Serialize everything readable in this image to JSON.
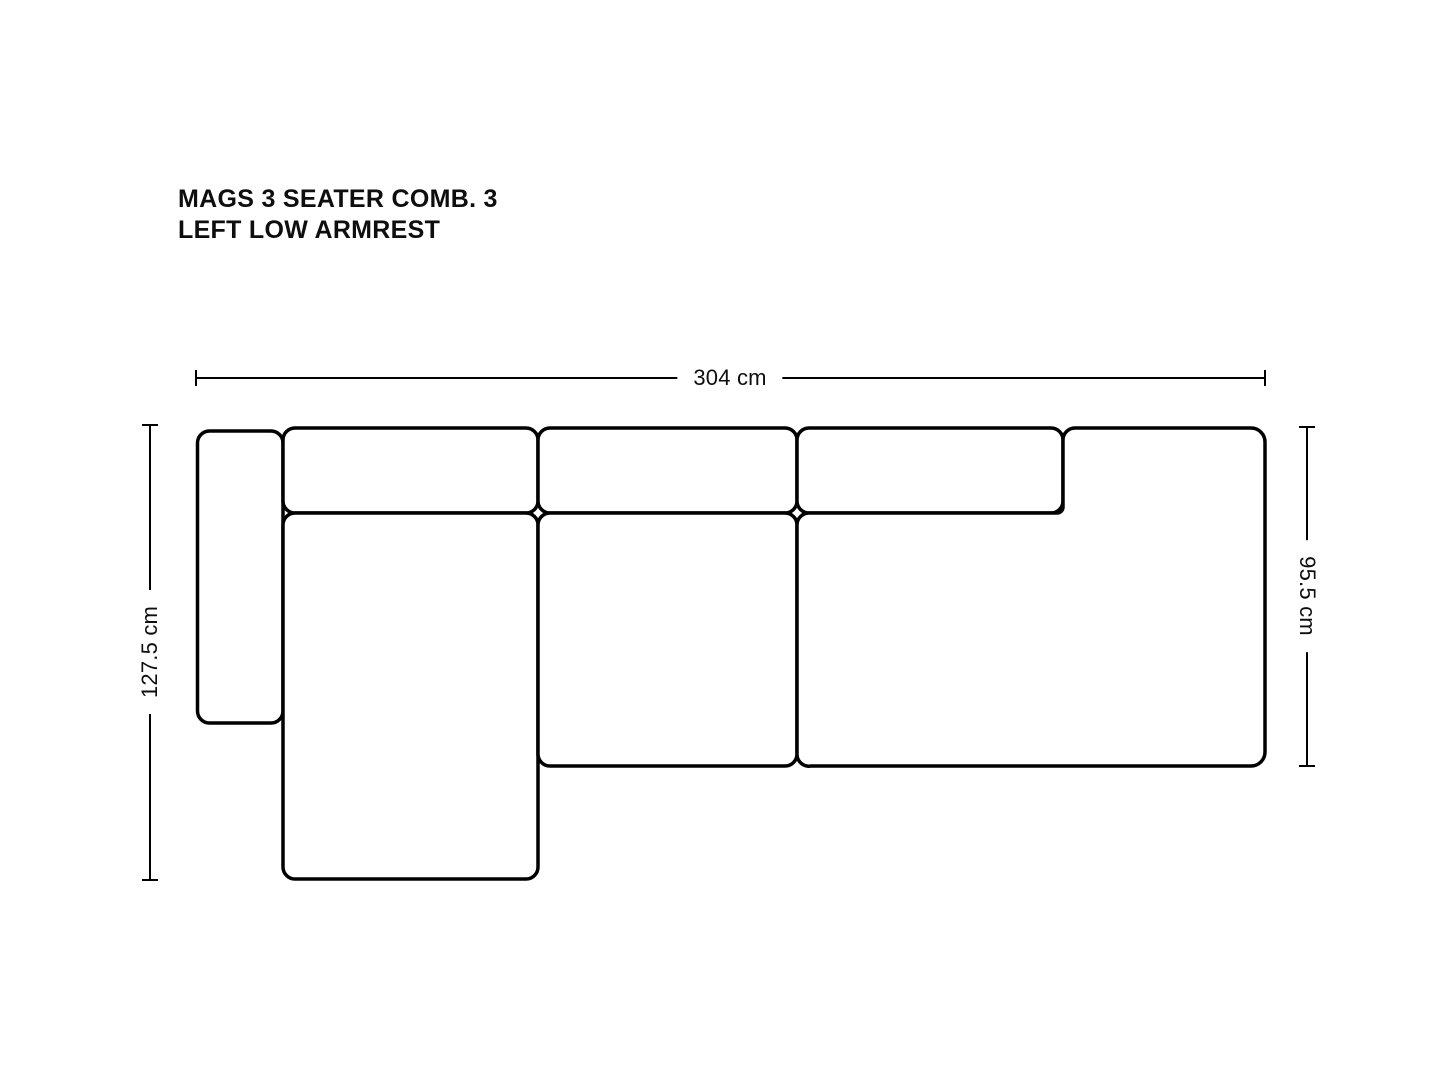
{
  "page": {
    "background_color": "#ffffff",
    "line_color": "#000000",
    "text_color": "#0e0e0e"
  },
  "title": {
    "line1": "MAGS 3 SEATER COMB. 3",
    "line2": "LEFT LOW ARMREST"
  },
  "dimensions": {
    "width": {
      "label": "304 cm",
      "orientation": "horizontal"
    },
    "depth_left": {
      "label": "127.5 cm",
      "orientation": "vertical-reading-up"
    },
    "depth_right": {
      "label": "95.5 cm",
      "orientation": "vertical-reading-down"
    }
  },
  "diagram": {
    "description": "Top view outline drawing of MAGS 3 seater sofa combination 3 with left low armrest and left chaise",
    "module_stroke_width": 3.5,
    "dim_stroke_width": 2,
    "rects": [
      {
        "name": "left-low-armrest",
        "x": 197.5,
        "y": 431,
        "w": 85.5,
        "h": 292,
        "r": 12
      },
      {
        "name": "back-cushion-1",
        "x": 283,
        "y": 428,
        "w": 255,
        "h": 85,
        "r": 12
      },
      {
        "name": "back-cushion-2",
        "x": 538,
        "y": 428,
        "w": 259,
        "h": 85,
        "r": 12
      },
      {
        "name": "back-cushion-3",
        "x": 797,
        "y": 428,
        "w": 266,
        "h": 85,
        "r": 12
      },
      {
        "name": "chaise-longue-seat",
        "x": 283,
        "y": 513,
        "w": 255,
        "h": 366,
        "r": 12
      },
      {
        "name": "middle-seat",
        "x": 538,
        "y": 513,
        "w": 259,
        "h": 253,
        "r": 12
      }
    ],
    "paths": [
      {
        "name": "right-seat-with-armrest",
        "d": "M 1075 428 H 1251 A 14 14 0 0 1 1265 442 V 752 A 14 14 0 0 1 1251 766 H 811 A 12 12 0 0 1 797 754 V 525 A 12 12 0 0 1 809 513 H 1057 A 6 6 0 0 0 1063 507 V 440 A 12 12 0 0 1 1075 428 Z"
      }
    ],
    "dim_lines": [
      {
        "name": "dim-width-line",
        "x1": 196,
        "y1": 378,
        "x2": 1265,
        "y2": 378
      },
      {
        "name": "dim-width-tick-left",
        "x1": 196,
        "y1": 370,
        "x2": 196,
        "y2": 386
      },
      {
        "name": "dim-width-tick-right",
        "x1": 1265,
        "y1": 370,
        "x2": 1265,
        "y2": 386
      },
      {
        "name": "dim-depth-left-line",
        "x1": 150,
        "y1": 425,
        "x2": 150,
        "y2": 880
      },
      {
        "name": "dim-depth-left-tick-top",
        "x1": 142,
        "y1": 425,
        "x2": 158,
        "y2": 425
      },
      {
        "name": "dim-depth-left-tick-bottom",
        "x1": 142,
        "y1": 880,
        "x2": 158,
        "y2": 880
      },
      {
        "name": "dim-depth-right-line",
        "x1": 1307,
        "y1": 427,
        "x2": 1307,
        "y2": 766
      },
      {
        "name": "dim-depth-right-tick-top",
        "x1": 1299,
        "y1": 427,
        "x2": 1315,
        "y2": 427
      },
      {
        "name": "dim-depth-right-tick-bottom",
        "x1": 1299,
        "y1": 766,
        "x2": 1315,
        "y2": 766
      }
    ]
  }
}
